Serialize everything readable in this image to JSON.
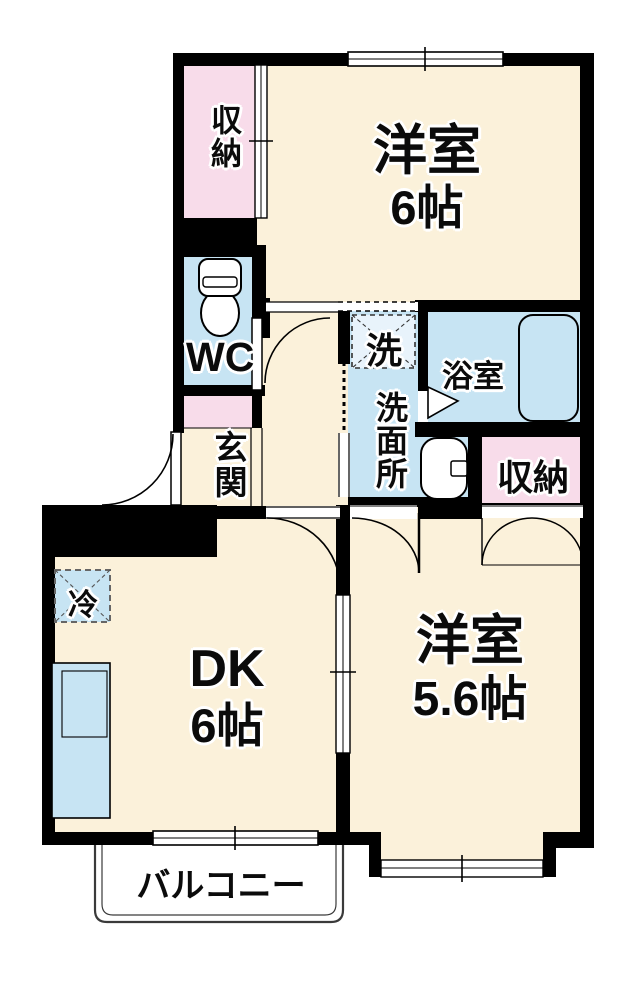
{
  "floorplan": {
    "type": "apartment-2DK",
    "rooms": {
      "western6": {
        "name": "洋室",
        "size": "6帖"
      },
      "western56": {
        "name": "洋室",
        "size": "5.6帖"
      },
      "dk": {
        "name": "DK",
        "size": "6帖"
      },
      "closet_top": {
        "label": "収納"
      },
      "closet_right": {
        "label": "収納"
      },
      "wc": {
        "label": "WC"
      },
      "washroom": {
        "label": "洗面所"
      },
      "bathroom": {
        "label": "浴室"
      },
      "entrance": {
        "label": "玄関"
      },
      "balcony": {
        "label": "バルコニー"
      }
    },
    "fixtures": {
      "washing_machine": {
        "label": "洗"
      },
      "refrigerator": {
        "label": "冷"
      },
      "toilet": {
        "icon": "toilet-icon"
      },
      "bathtub": {
        "icon": "bathtub-icon"
      },
      "sink": {
        "icon": "sink-icon"
      },
      "kitchen_counter": {
        "icon": "kitchen-counter-icon"
      }
    },
    "colors": {
      "room_cream": "#FBF1DA",
      "closet_pink": "#F8DCEA",
      "water_blue": "#C7E4F3",
      "washer_box_blue": "#E8F3FB",
      "wall_black": "#000000"
    }
  }
}
